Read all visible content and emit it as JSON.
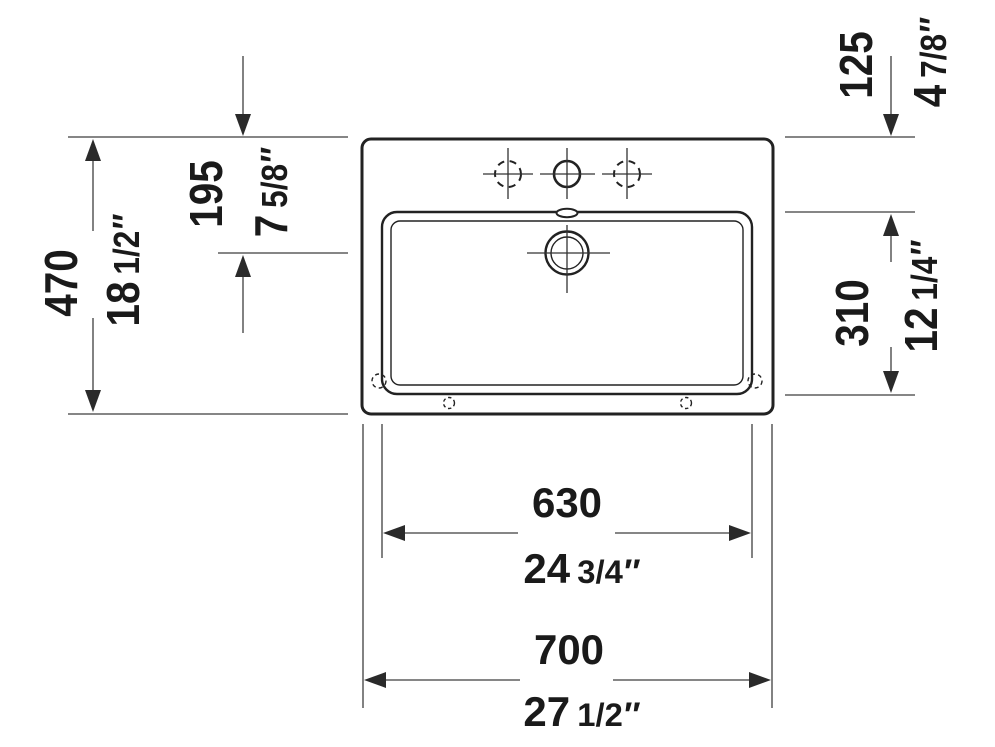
{
  "inch_mark": "″",
  "dimensions": {
    "width_overall": {
      "mm": "700",
      "inch_whole": "27",
      "inch_frac": "1/2"
    },
    "width_basin": {
      "mm": "630",
      "inch_whole": "24",
      "inch_frac": "3/4"
    },
    "depth_overall": {
      "mm": "470",
      "inch_whole": "18",
      "inch_frac": "1/2"
    },
    "edge_to_drain": {
      "mm": "195",
      "inch_whole": "7",
      "inch_frac": "5/8"
    },
    "edge_to_basin": {
      "mm": "125",
      "inch_whole": "4",
      "inch_frac": "7/8"
    },
    "basin_depth": {
      "mm": "310",
      "inch_whole": "12",
      "inch_frac": "1/4"
    }
  },
  "colors": {
    "background": "#ffffff",
    "outline": "#222222",
    "dimension_line": "#3f3f3f",
    "text": "#1a1a1a"
  }
}
